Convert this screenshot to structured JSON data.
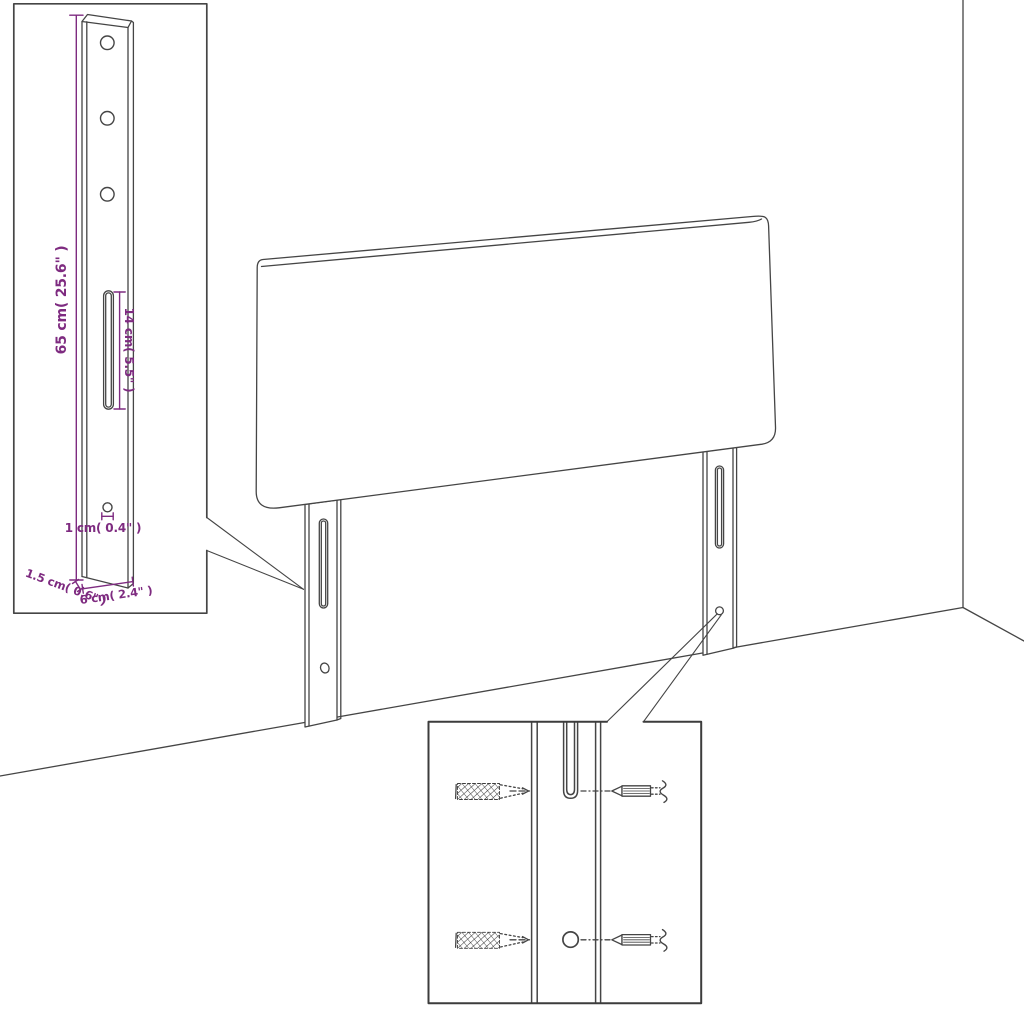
{
  "figure": {
    "kind": "product-dimension-diagram",
    "subject": "upholstered headboard with two slotted mounting legs standing against a wall corner",
    "background_color": "#ffffff",
    "line_color": "#454545",
    "dimension_color": "#7e2b80"
  },
  "callout_leg_dimensions": {
    "description": "magnified side view of one mounting leg with measurements",
    "holes_count": 3,
    "labels": {
      "height": "65 cm( 25.6\" )",
      "slot_length": "14 cm( 5.5\" )",
      "hole_diameter": "1 cm( 0.4\" )",
      "thickness": "1.5 cm( 0.6\" )",
      "width": "6 cm( 2.4\" )"
    }
  },
  "callout_mounting_hardware": {
    "description": "magnified view of leg slot and hole with screws and wall plugs",
    "screws_count": 2,
    "wall_plugs_count": 2
  }
}
